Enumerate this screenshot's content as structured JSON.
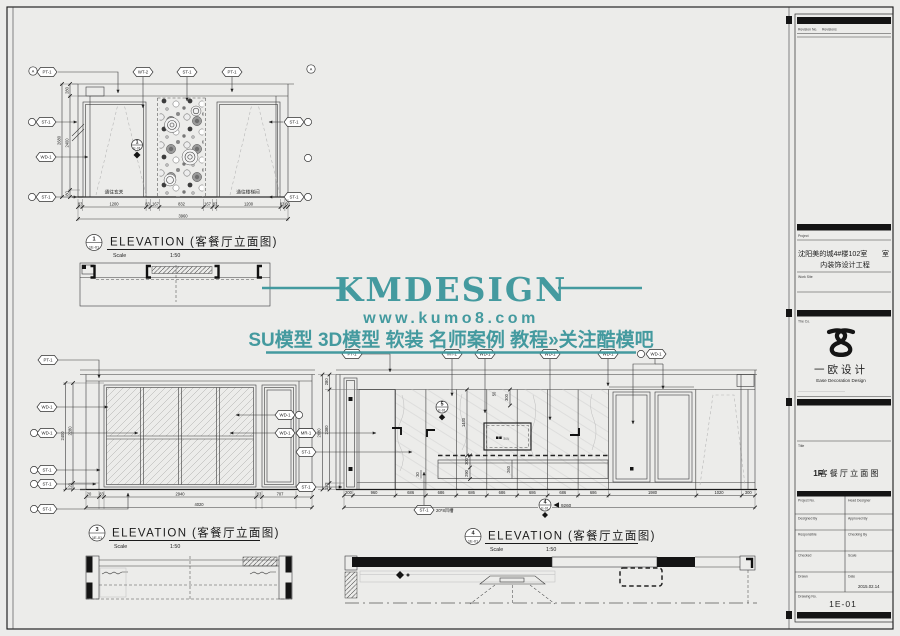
{
  "wm": {
    "brand": "KMDESIGN",
    "url": "www.kumo8.com",
    "tagline": "SU模型 3D模型 软装 名师案例 教程»关注酷模吧",
    "color": "#3c969b"
  },
  "d1": {
    "num": "1",
    "ref": "1E-01",
    "title": "ELEVATION (客餐厅立面图)",
    "scale_label": "Scale",
    "scale": "1:50",
    "grid_a": "A",
    "hex": {
      "t1": "PT-1",
      "t2": "WT-2",
      "t3": "ST-1",
      "t4": "PT-1",
      "l1": "ST-1",
      "l2": "WD-1",
      "l3": "ST-1",
      "r1": "ST-1",
      "r2": "ST-1"
    },
    "vd": [
      "280",
      "2400",
      "2680",
      "80"
    ],
    "bd": [
      "83",
      "1200",
      "83",
      "167",
      "832",
      "167",
      "83",
      "1200",
      "83",
      "60"
    ],
    "total": "3960",
    "room_left": "通往玄关",
    "room_right": "通往楼梯间",
    "mk": {
      "n": "1",
      "s": "E-01"
    }
  },
  "d3": {
    "num": "3",
    "ref": "1E-01",
    "title": "ELEVATION (客餐厅立面图)",
    "scale_label": "Scale",
    "scale": "1:50",
    "hex": {
      "t1": "PT-1",
      "l1": "WD-1",
      "l2": "WD-1",
      "l3": "ST-1",
      "l4": "ST-1",
      "l5": "ST-1",
      "r1": "WD-1",
      "r2": "WD-1",
      "r3": "MR-1"
    },
    "vd": [
      "2400",
      "2280",
      "120"
    ],
    "bd": [
      "20",
      "83",
      "2940",
      "83",
      "707"
    ],
    "total": "4020"
  },
  "d4": {
    "num": "4",
    "ref": "1E-01",
    "title": "ELEVATION (客餐厅立面图)",
    "scale_label": "Scale",
    "scale": "1:50",
    "hex": {
      "t1": "PT-1",
      "t2": "MT-1",
      "t3": "WD-1",
      "t4": "WD-1",
      "t5": "WD-1",
      "t6": "WD-1",
      "l1": "MR-1",
      "l2": "ST-1",
      "l3": "ST-1"
    },
    "vd": [
      "280",
      "2680",
      "2380",
      "130"
    ],
    "id": {
      "a": "1430",
      "b": "300",
      "c": "50",
      "d": "300",
      "e": "290",
      "f": "260",
      "g": "30"
    },
    "bd": [
      "200",
      "960",
      "686",
      "686",
      "686",
      "686",
      "686",
      "686",
      "686",
      "1980",
      "1020",
      "300"
    ],
    "total": "9260",
    "niche": "80N",
    "note_hex": "ST-1",
    "note": "20*8凹槽",
    "mk5": {
      "n": "5",
      "s": "E-01"
    },
    "mk4": {
      "n": "4",
      "s": "E-01"
    }
  },
  "tb": {
    "rev": "Revision No.",
    "revs": "Revisions",
    "project_label": "Project",
    "p1": "沈阳美的城4#楼102室",
    "p1b": "室",
    "p2": "内装饰设计工程",
    "worksite": "Work Site",
    "co": "The Co.",
    "logo_cn": "一欧设计",
    "logo_en": "Ease Decoration Design",
    "title_label": "Title",
    "t_pre": "1F",
    "t_main": "客餐厅立面图",
    "f": {
      "pn": "Project No.",
      "hd": "Head Designer",
      "db": "Designed By",
      "ab": "Approved By",
      "rs": "Responsible",
      "cb": "Checking By",
      "ck": "Checked",
      "sc": "Scale",
      "dr": "Drawn",
      "dt": "Date",
      "date": "2015.02.14",
      "dn": "Drawing No.",
      "no": "1E-01"
    }
  }
}
